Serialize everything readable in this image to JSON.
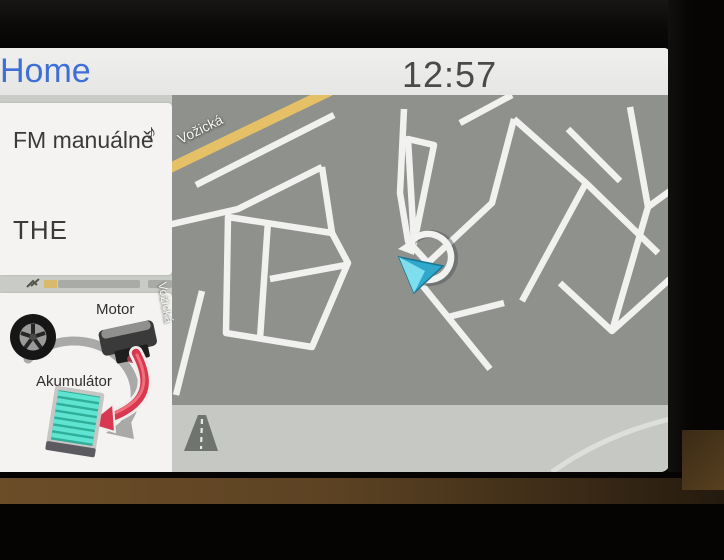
{
  "statusbar": {
    "home_label": "Home",
    "time": "12:57"
  },
  "media_widget": {
    "source_label": "FM manuálně",
    "station": "THE",
    "icon": "music-note-icon"
  },
  "energy_widget": {
    "motor_label": "Motor",
    "battery_label": "Akumulátor",
    "elements": [
      "wheel",
      "motor",
      "battery",
      "energy-flow-arrow"
    ],
    "flow_state": "motor-charging-battery"
  },
  "map": {
    "street_labels": {
      "diagonal": "Vožická",
      "vertical": "Vožická"
    },
    "icons": [
      "vehicle-position-icon",
      "heading-ring-icon",
      "motorway-icon"
    ]
  },
  "colors": {
    "accent_blue": "#3f6fd6",
    "clock_text": "#4a4a48",
    "map_gray": "#8e918c",
    "map_light_zone": "#c6c8c3",
    "road_white": "#f1f1ef",
    "road_yellow": "#e6c066",
    "battery_teal": "#58e2ce",
    "flow_red": "#d83850",
    "card_white": "#f4f3f1",
    "trim_brown": "#5d4323"
  }
}
